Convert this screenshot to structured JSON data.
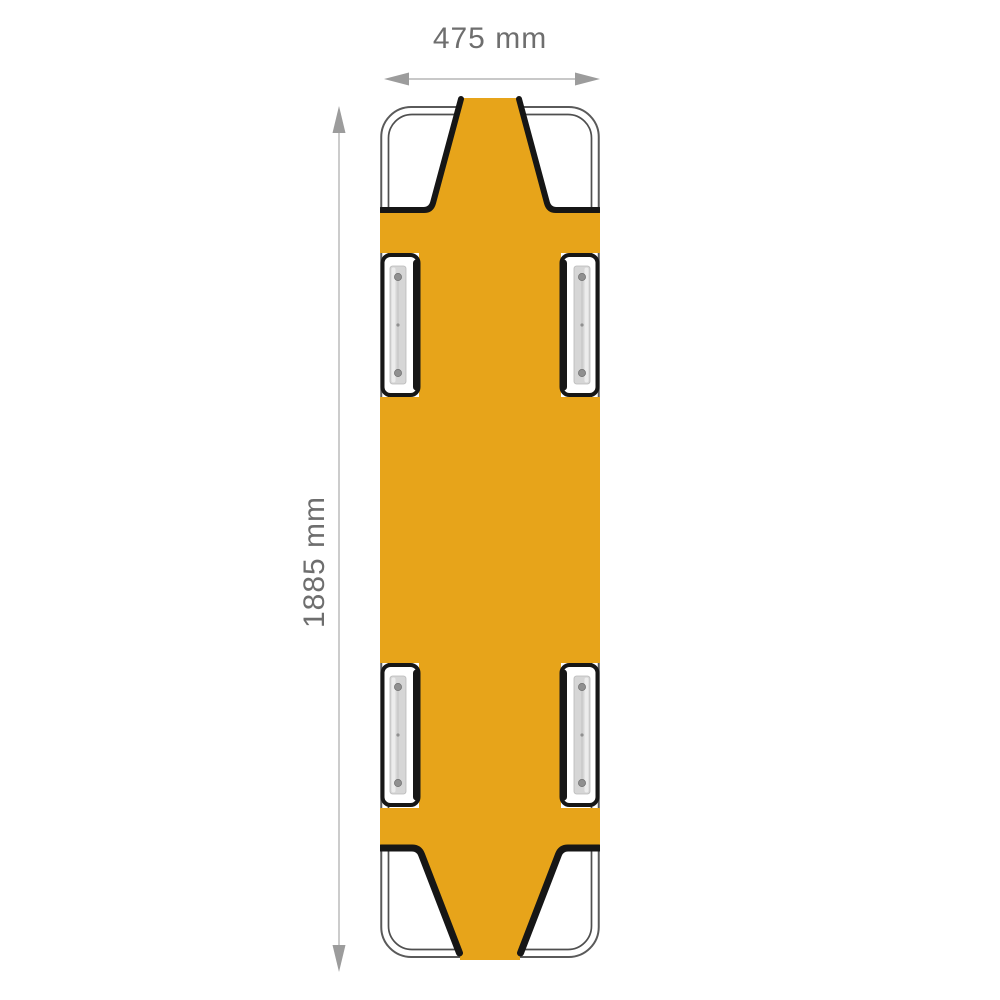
{
  "diagram": {
    "subject": "folding pole stretcher - top view",
    "orientation": "vertical",
    "handle_slots": 4,
    "width": {
      "label": "475 mm",
      "value_mm": 475
    },
    "height": {
      "label": "1885 mm",
      "value_mm": 1885
    },
    "colors": {
      "fabric": "#E7A41A",
      "trim": "#161616",
      "frame": "#5A5A5A",
      "metal": "#D6D6D6",
      "annotation": "#9C9C9C",
      "annotation-line": "#B6B6B6",
      "label-text": "#6E6E6E",
      "background": "#FFFFFF"
    }
  }
}
